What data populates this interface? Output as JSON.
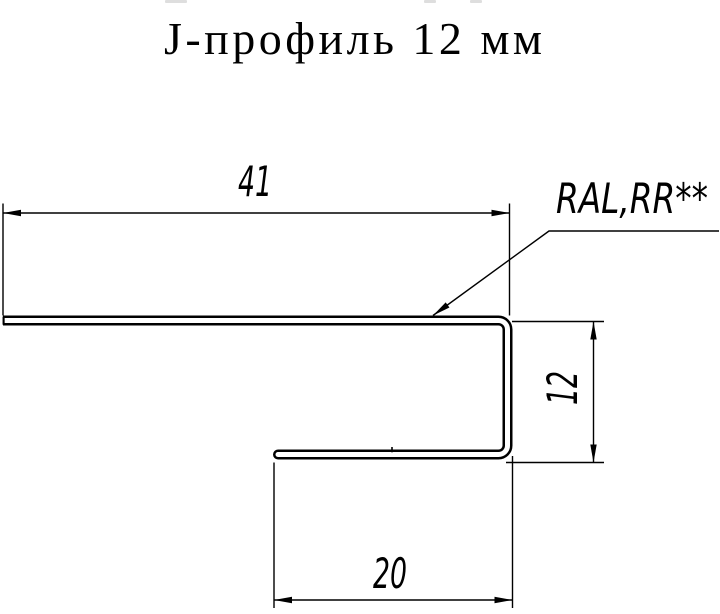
{
  "title": "J-профиль 12 мм",
  "drawing": {
    "coating_label": "RAL,RR**",
    "dimensions": {
      "top_flange": "41",
      "web_height": "12",
      "bottom_lip": "20"
    }
  },
  "colors": {
    "line": "#000000",
    "background": "#ffffff"
  }
}
